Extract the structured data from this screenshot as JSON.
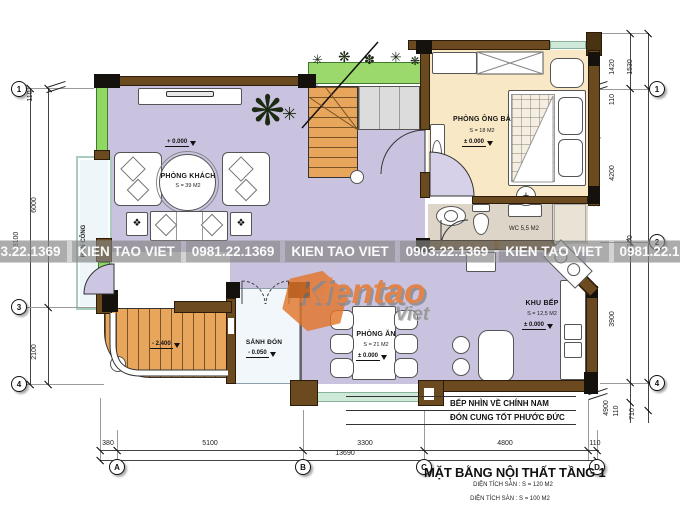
{
  "watermark": {
    "segments": [
      "0903.22.1369",
      "KIEN TAO VIET",
      "0981.22.1369",
      "KIEN TAO VIET",
      "0903.22.1369",
      "KIEN TAO VIET",
      "0981.22.1369"
    ],
    "logo_main": "Kientao",
    "logo_sub": "Viet"
  },
  "title": {
    "main": "MẶT BẰNG NỘI THẤT TẦNG 1",
    "sub1": "DIỆN TÍCH SÀN : S = 120 M2",
    "sub2": "DIỆN TÍCH SÀN : S = 100 M2"
  },
  "rooms": {
    "living": {
      "name": "PHÒNG KHÁCH",
      "area": "S = 39 M2",
      "level": "+ 0.000"
    },
    "master": {
      "name": "PHÒNG ÔNG BÀ",
      "area": "S = 18 M2",
      "level": "± 0.000"
    },
    "wc": {
      "name": "WC 5,5 M2"
    },
    "kitchen": {
      "name": "KHU BẾP",
      "area": "S = 12,5 M2",
      "level": "± 0.000"
    },
    "dining": {
      "name": "PHÒNG ĂN",
      "area": "S = 21 M2",
      "level": "± 0.000"
    },
    "hall": {
      "name": "SẢNH ĐÓN",
      "level": "- 0.050"
    },
    "balcony": {
      "name": "BAN CÔNG"
    },
    "ext_stair": {
      "level": "- 2.400"
    }
  },
  "notes": {
    "right_vertical": "XÍ CHẮN CUNG NGŨ QUÝ",
    "kitchen_line1": "BẾP NHÌN VỀ CHÍNH NAM",
    "kitchen_line2": "ĐÓN CUNG TỐT PHƯỚC ĐỨC"
  },
  "grid": {
    "left": [
      "1",
      "3",
      "4"
    ],
    "right": [
      "1",
      "2",
      "4"
    ],
    "bottom": [
      "A",
      "B",
      "C",
      "D"
    ]
  },
  "dims": {
    "left": [
      "110",
      "6000",
      "2100",
      "8100"
    ],
    "right": [
      "1420",
      "1530",
      "110",
      "4200",
      "8100",
      "3900",
      "4900",
      "110",
      "710"
    ],
    "bottom": [
      "380",
      "5100",
      "3300",
      "4800",
      "110"
    ],
    "bottom_total": "13690"
  },
  "colors": {
    "wall": "#6b4a1f",
    "floor_main": "#cac3e0",
    "floor_bedroom": "#f8e8c6",
    "stair": "#e8a55c",
    "glass": "#8ed863",
    "logo_accent": "#e8772a"
  }
}
